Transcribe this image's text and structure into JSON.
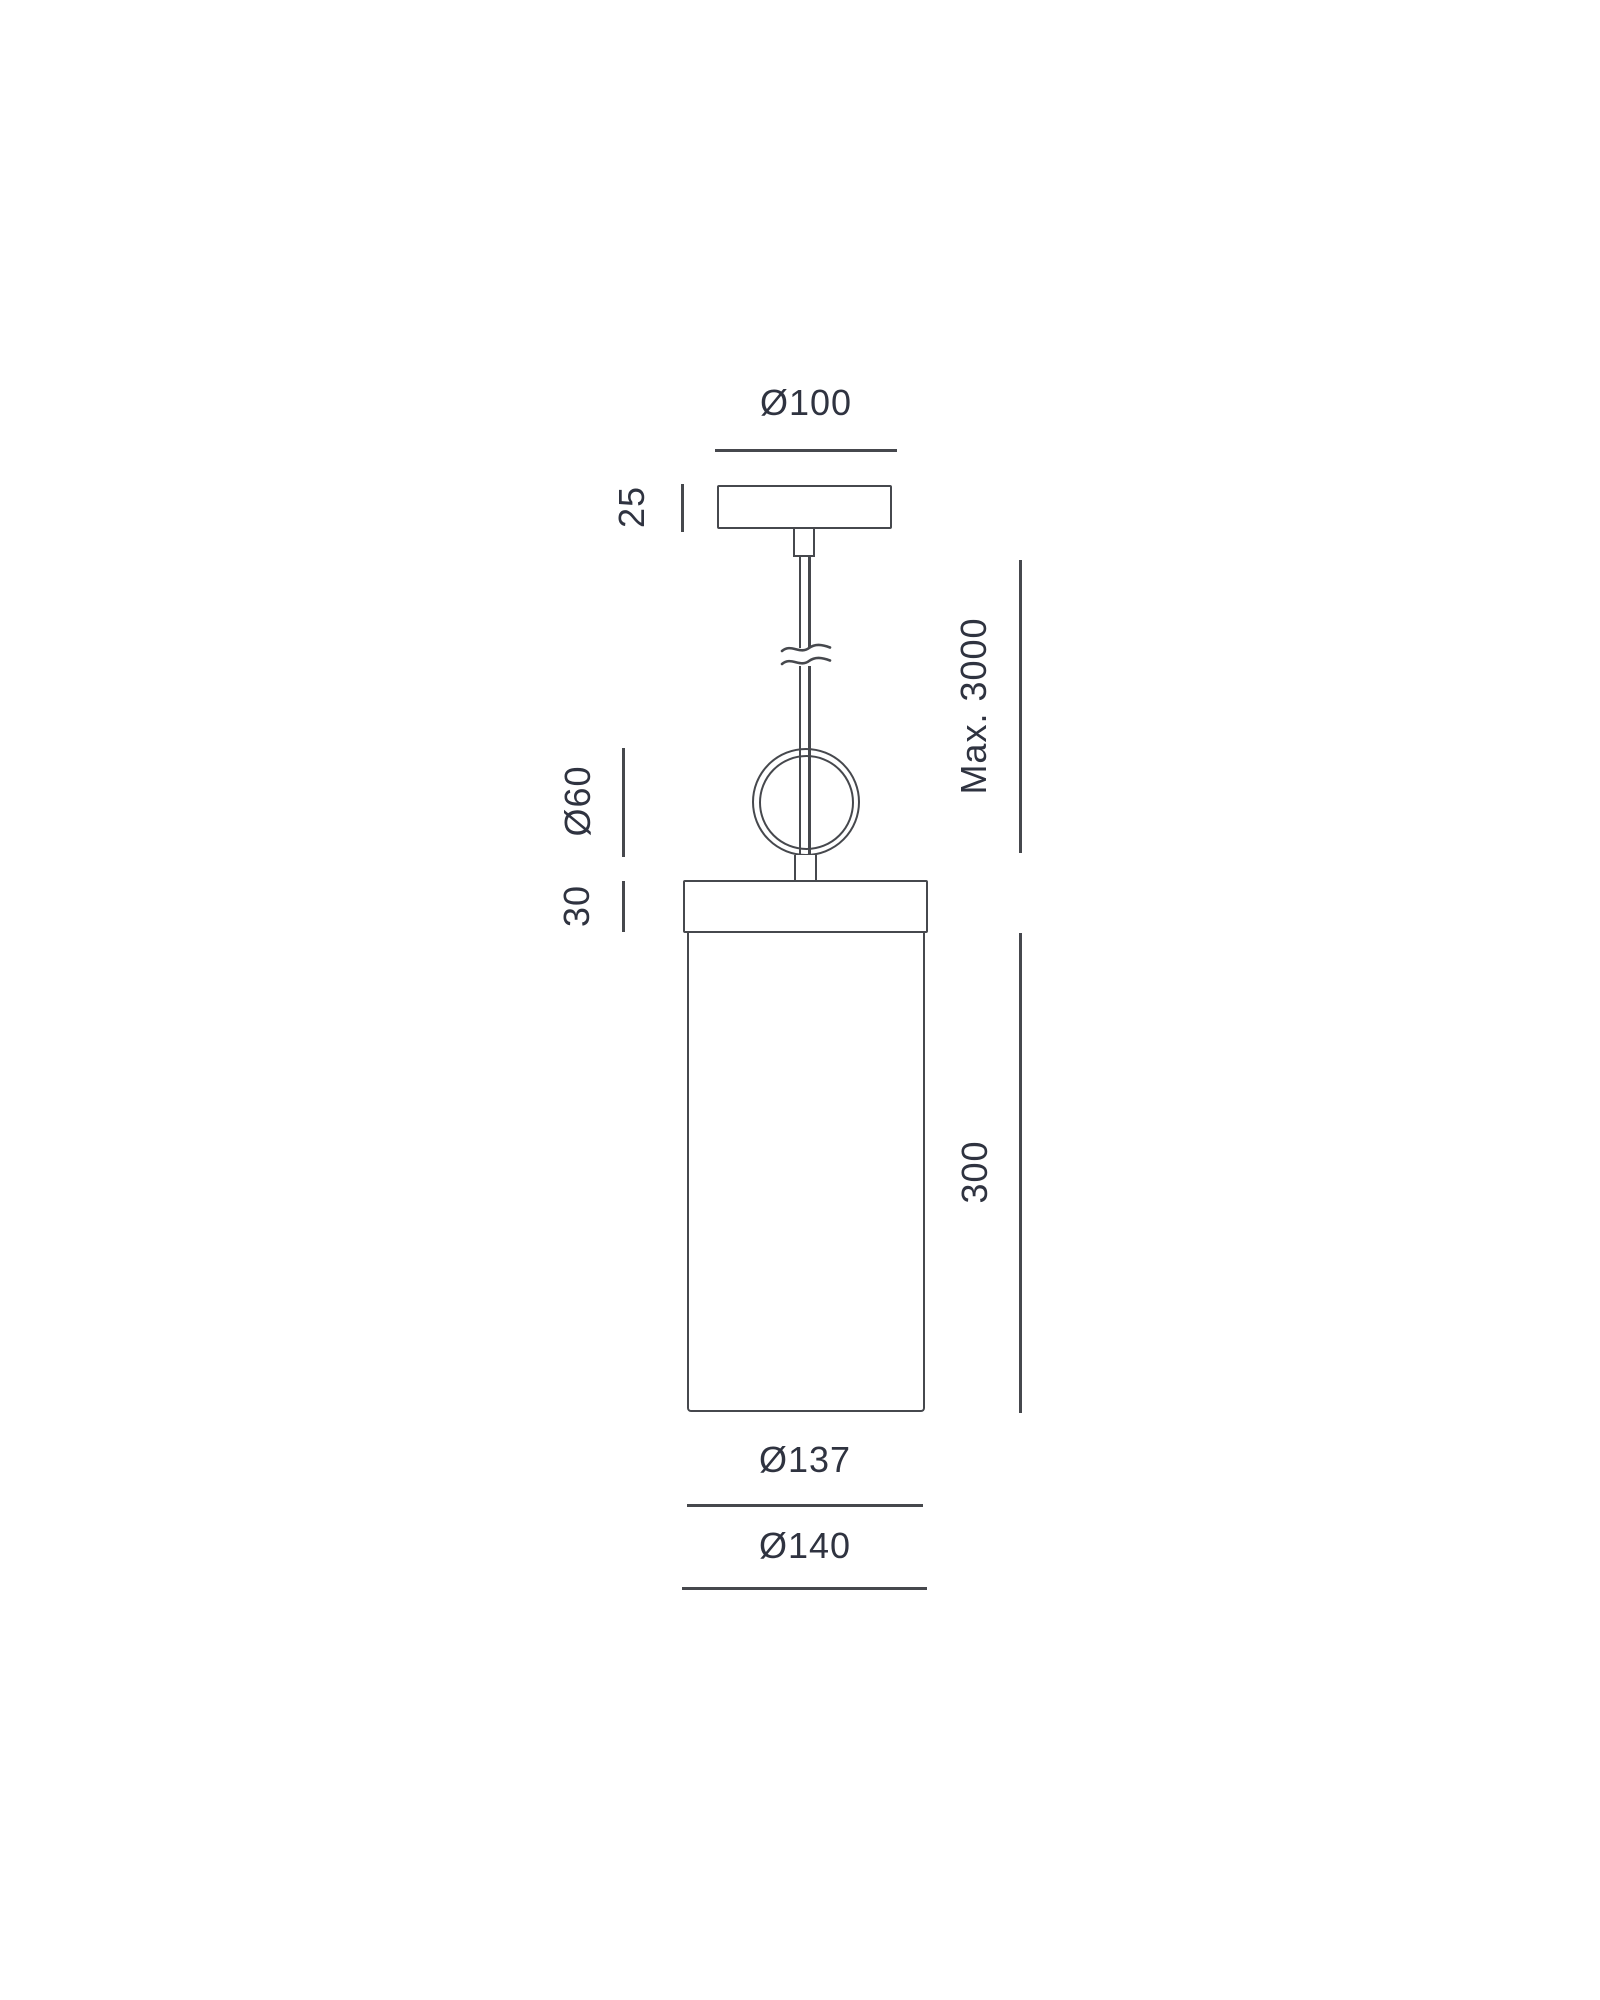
{
  "diagram": {
    "type": "technical-dimension-drawing",
    "subject": "cylindrical pendant lamp, front elevation",
    "labels": {
      "canopy_diameter": "Ø100",
      "canopy_height": "25",
      "ring_diameter": "Ø60",
      "cap_height": "30",
      "max_suspension": "Max. 3000",
      "shade_height": "300",
      "shade_inner_diameter": "Ø137",
      "shade_outer_diameter": "Ø140"
    },
    "dimensions_mm": {
      "canopy_diameter": 100,
      "canopy_height": 25,
      "ring_diameter": 60,
      "cap_height": 30,
      "max_suspension": 3000,
      "shade_height": 300,
      "shade_inner_diameter": 137,
      "shade_outer_diameter": 140
    },
    "colors": {
      "line": "#46484d",
      "text": "#2f3340",
      "background": "#ffffff"
    }
  }
}
